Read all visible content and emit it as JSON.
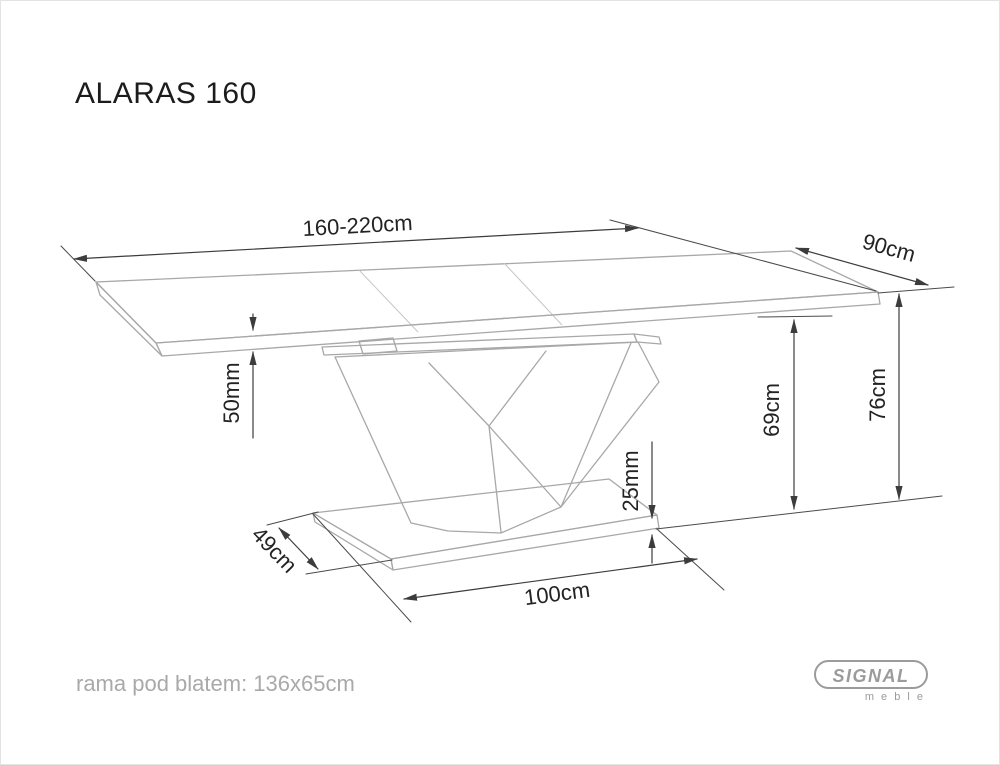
{
  "title": "ALARAS 160",
  "dimensions": {
    "top_length": "160-220cm",
    "top_depth": "90cm",
    "top_thickness": "50mm",
    "height_under_frame": "69cm",
    "total_height": "76cm",
    "base_thickness": "25mm",
    "base_depth": "49cm",
    "base_length": "100cm"
  },
  "footer_note": "rama pod blatem: 136x65cm",
  "logo": {
    "brand": "SIGNAL",
    "subtext": "m e b l e"
  },
  "colors": {
    "background": "#ffffff",
    "dimension_line": "#3c3c3c",
    "object_line": "#a8a8a8",
    "text": "#232323",
    "muted_text": "#a9a9a9",
    "logo_gray": "#9b9b9b"
  }
}
